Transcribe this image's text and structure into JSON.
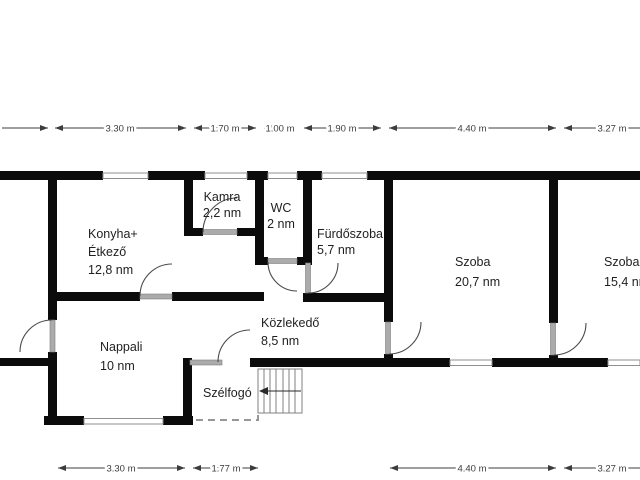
{
  "plan": {
    "unit_area": "nm",
    "unit_length": "m",
    "colors": {
      "wall": "#0b0b0b",
      "window": "#8f8f8f",
      "door": "#ababab",
      "text": "#1f1f1f",
      "dim_text": "#3c3c3c",
      "dashed": "#979797"
    }
  },
  "rooms": {
    "konyha_etkezo": {
      "name_line1": "Konyha+",
      "name_line2": "Étkező",
      "area": "12,8 nm"
    },
    "kamra": {
      "name": "Kamra",
      "area": "2,2 nm"
    },
    "wc": {
      "name": "WC",
      "area": "2 nm"
    },
    "furdoszoba": {
      "name": "Fürdőszoba",
      "area": "5,7 nm"
    },
    "szoba_nagy": {
      "name": "Szoba",
      "area": "20,7 nm"
    },
    "szoba_kis": {
      "name": "Szoba",
      "area": "15,4 nm"
    },
    "nappali": {
      "name": "Nappali",
      "area": "10 nm"
    },
    "kozlekedo": {
      "name": "Közlekedő",
      "area": "8,5 nm"
    },
    "szelfogo": {
      "name": "Szélfogó"
    }
  },
  "dimensions": {
    "top": [
      "3.30 m",
      "1.70 m",
      "1.00 m",
      "1.90 m",
      "4.40 m",
      "3.27 m"
    ],
    "bottom": [
      "3.30 m",
      "1.77 m",
      "4.40 m",
      "3.27 m"
    ]
  }
}
